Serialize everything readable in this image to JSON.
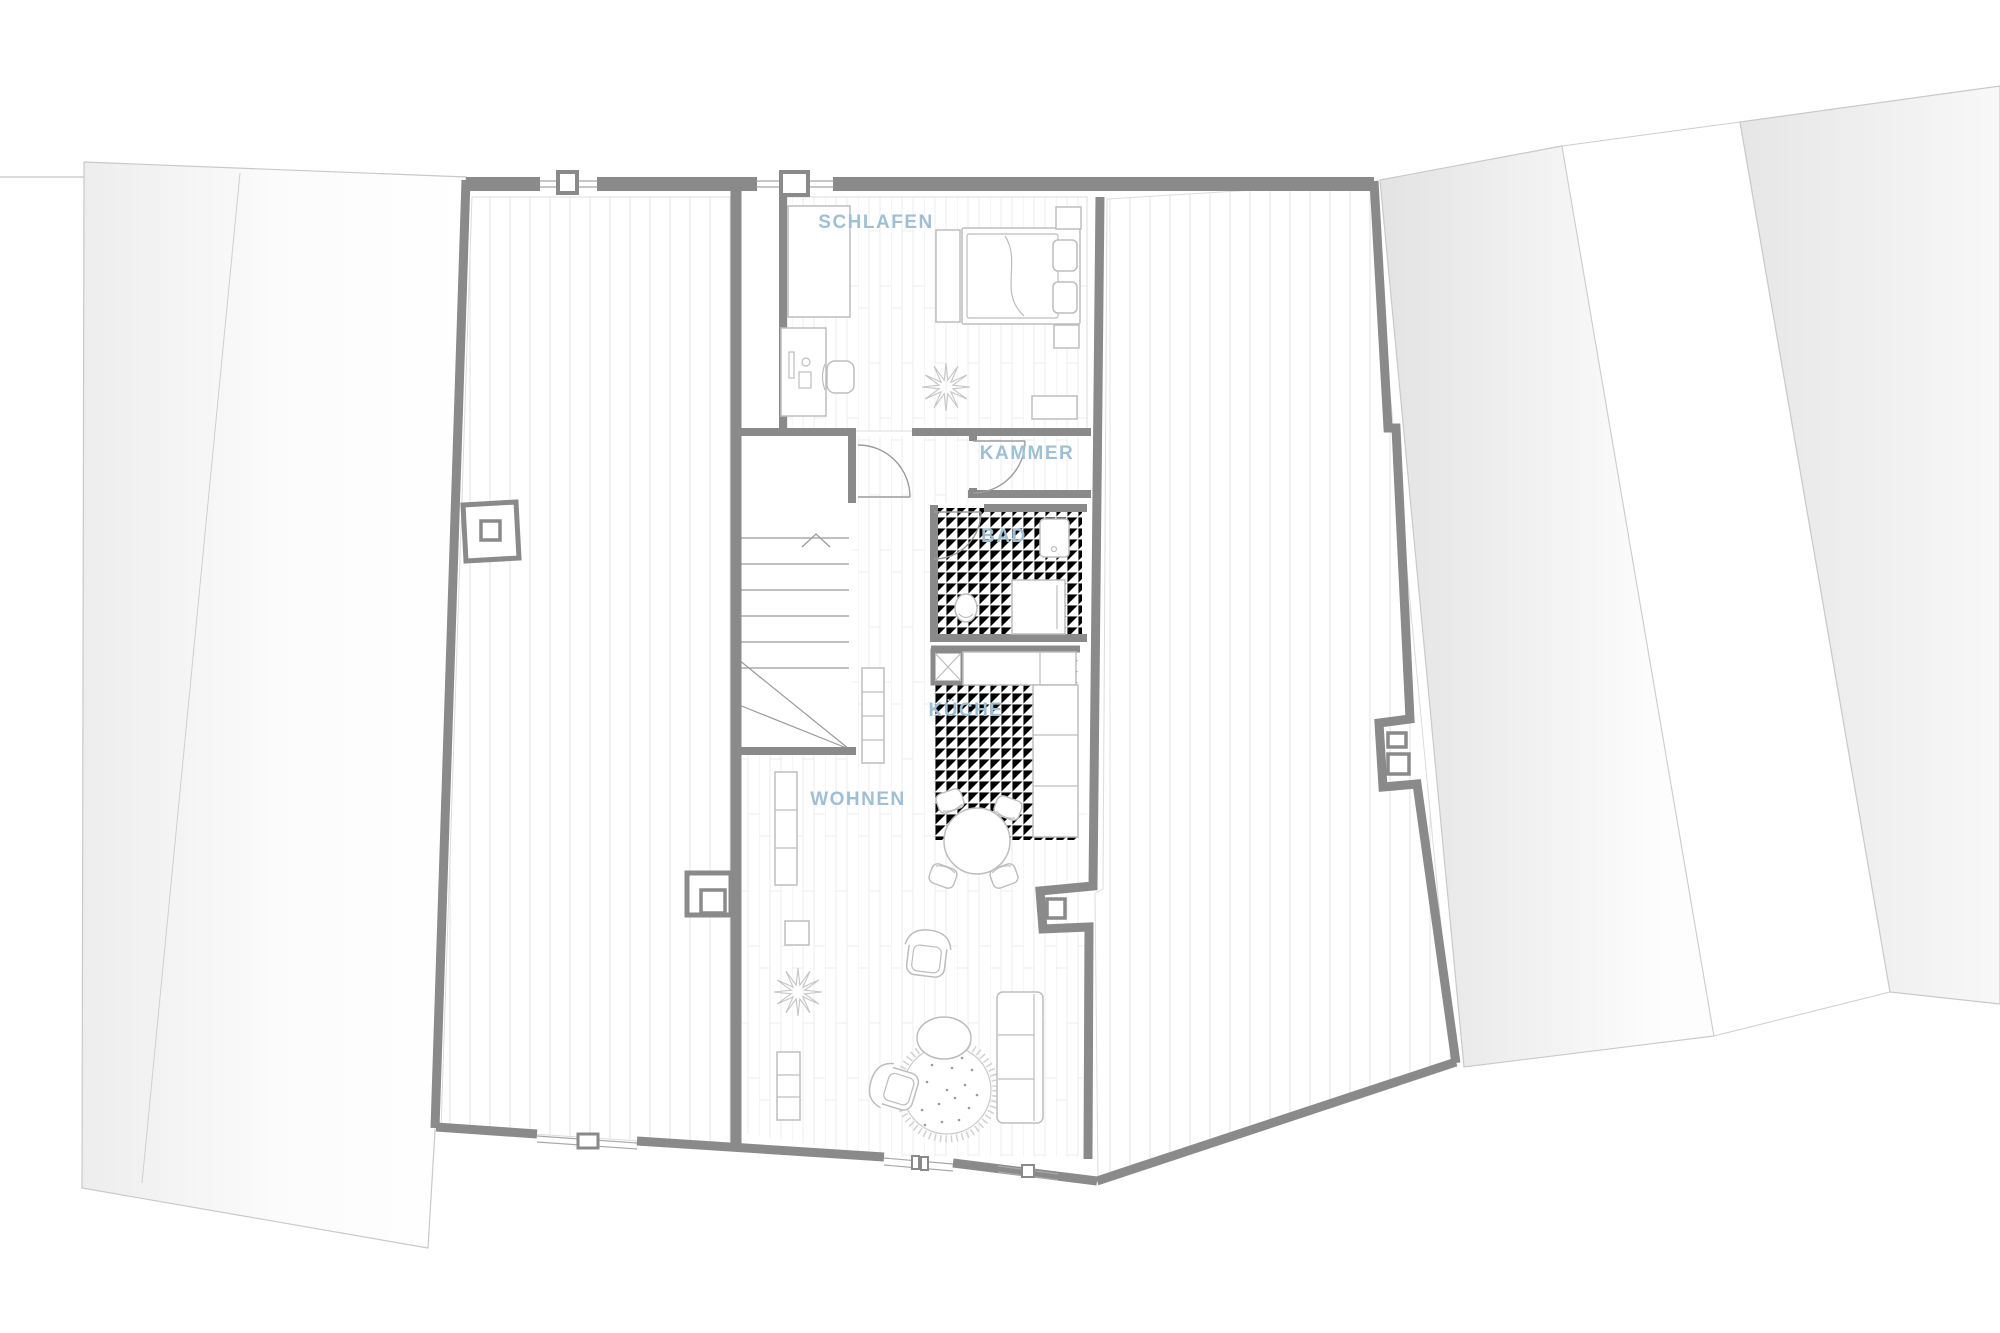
{
  "document": {
    "type": "architectural-floor-plan",
    "language": "de"
  },
  "rooms": [
    {
      "name": "schlafen",
      "label": "SCHLAFEN"
    },
    {
      "name": "kammer",
      "label": "KAMMER"
    },
    {
      "name": "bad",
      "label": "BAD"
    },
    {
      "name": "kueche",
      "label": "KÜCHE"
    },
    {
      "name": "wohnen",
      "label": "WOHNEN"
    }
  ],
  "furniture": [
    "wardrobe",
    "desk",
    "desk-chair",
    "double-bed",
    "nightstand",
    "plant",
    "shelf",
    "washbasin",
    "toilet",
    "shower",
    "kitchen-counter",
    "dining-table",
    "dining-chair",
    "armchair",
    "pouf",
    "round-rug",
    "sofa",
    "staircase"
  ],
  "colors": {
    "label-color": "#9fbfd4",
    "wall-color": "#8a8a8a",
    "furniture-color": "#bdbdbd",
    "neighbor-line-color": "#c9c9c9",
    "hatch-color": "#ececec"
  }
}
